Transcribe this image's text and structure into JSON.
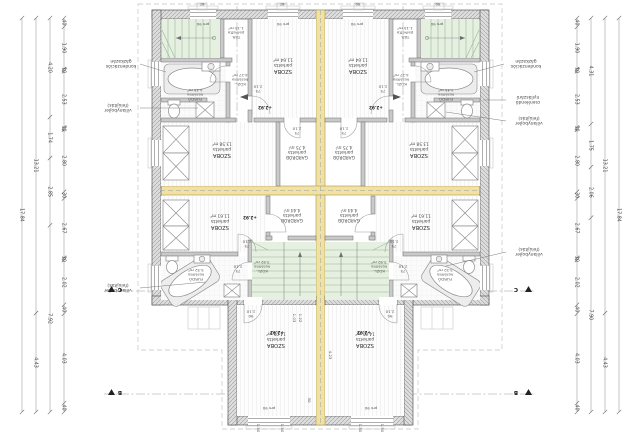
{
  "rooms": {
    "szoba_a": {
      "name": "SZOBA",
      "floor": "parketta",
      "area": "11.64 m²"
    },
    "tar": {
      "name": "TÁR.",
      "floor": "parketta",
      "area": "1.15 m²"
    },
    "kozl_fel": {
      "name": "KÖZL.",
      "floor": "kerámia",
      "area": "4.27 m²"
    },
    "furdo_fel": {
      "name": "FÜRDŐ",
      "floor": "kerámia",
      "area": "4.45 m²"
    },
    "szoba_b": {
      "name": "SZOBA",
      "floor": "parketta",
      "area": "13.58 m²"
    },
    "gardrob_a": {
      "name": "GARDRÓB",
      "floor": "parketta",
      "area": "4.75 m²"
    },
    "szoba_c": {
      "name": "SZOBA",
      "floor": "parketta",
      "area": "11.61 m²"
    },
    "gardrob_b": {
      "name": "GARDRÓB",
      "floor": "parketta",
      "area": "4.44 m²"
    },
    "furdo_also": {
      "name": "FÜRDŐ",
      "floor": "kerámia",
      "area": "5.52 m²"
    },
    "kozl_also": {
      "name": "KÖZL.",
      "floor": "kerámia",
      "area": "3.92 m²"
    },
    "szoba_d": {
      "name": "SZOBA",
      "floor": "parketta",
      "area": "14.05 m²"
    }
  },
  "labels": {
    "level": "+2.92",
    "sill": "pm 90",
    "vent": "60",
    "door75": "75",
    "door90": "90",
    "door_h": "2.10",
    "dim_423": "4.23",
    "dim_150": "1.50",
    "dim_103": "1.03",
    "dim_122": "1.22",
    "dim_30": "30"
  },
  "annotations": {
    "boiler1": "kondenzációs",
    "boiler2": "gázkazán",
    "el1": "villanybojler",
    "el2": "(felújítás)",
    "win1": "cserélendő",
    "win2": "nyílászáró"
  },
  "sections": {
    "b": "B",
    "c": "C"
  },
  "dims": {
    "left_inner": [
      "40",
      "1.90",
      "10",
      "2.53",
      "10",
      "2.80",
      "30",
      "2.67",
      "10",
      "2.02",
      "40",
      "4.03",
      "40"
    ],
    "left_mid": [
      "4.20",
      "1.74",
      "2.85",
      "7.92"
    ],
    "left_outer": [
      "13.21",
      "4.43"
    ],
    "left_total": [
      "17.84"
    ],
    "right_inner": [
      "40",
      "1.90",
      "10",
      "2.53",
      "10",
      "2.80",
      "30",
      "2.67",
      "10",
      "2.02",
      "40",
      "4.03",
      "40"
    ],
    "right_mid": [
      "4.31",
      "1.75",
      "2.06",
      "7.90"
    ],
    "right_outer": [
      "13.21",
      "4.43"
    ],
    "right_total": [
      "17.84"
    ]
  },
  "colors": {
    "highlight_wall": "#f0e2a2",
    "stair_fill": "#e6f0e1",
    "wall_hatch": "#dedede"
  }
}
